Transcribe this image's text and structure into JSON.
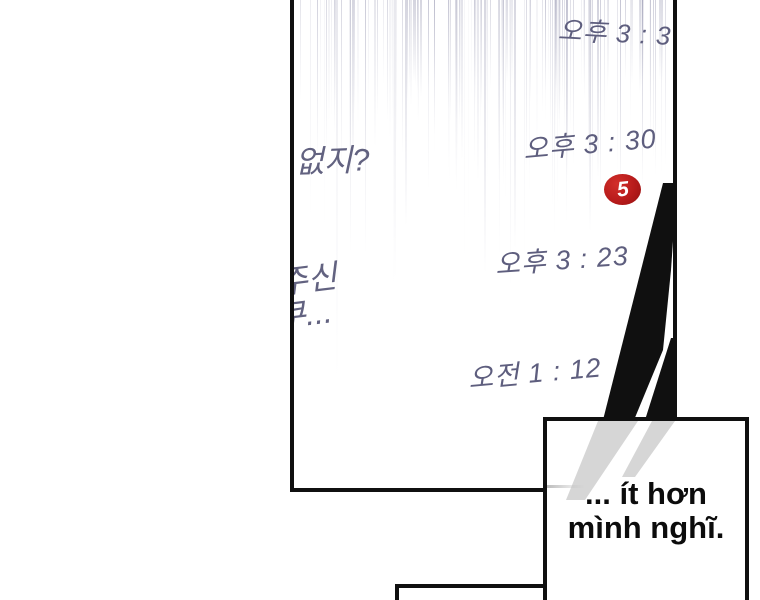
{
  "chat": {
    "timestamps": [
      {
        "label": "오후 3 : 37"
      },
      {
        "label": "오후 3 : 30"
      },
      {
        "label": "오후 3 : 23"
      },
      {
        "label": "오전 1 : 12"
      }
    ],
    "clipped_messages": [
      {
        "text": "이 없지?"
      },
      {
        "text": "주신"
      },
      {
        "text": "쿠..."
      }
    ],
    "unread_badge": {
      "count": "5"
    }
  },
  "speech_bubble": {
    "lines": [
      "... ít hơn",
      "mình nghĩ."
    ]
  },
  "colors": {
    "ink": "#101010",
    "timestamp_text": "#5e5e7e",
    "message_text": "#626280",
    "badge_red": "#b71b1b",
    "stripe_gray": "#d6d6d6"
  }
}
